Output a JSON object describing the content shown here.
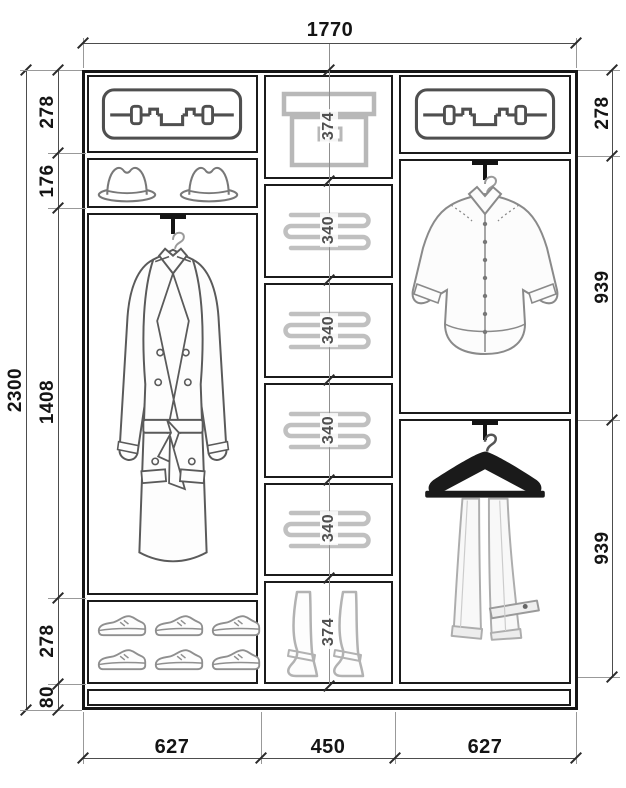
{
  "diagram": {
    "type": "wardrobe-interior-elevation",
    "units": "mm",
    "overall": {
      "width": "1770",
      "height": "2300"
    },
    "left_segments": [
      "278",
      "176",
      "1408",
      "278",
      "80"
    ],
    "middle_segments": [
      "374",
      "340",
      "340",
      "340",
      "340",
      "374"
    ],
    "right_segments": [
      "278",
      "939",
      "939"
    ],
    "bottom_widths": [
      "627",
      "450",
      "627"
    ],
    "icons": [
      {
        "name": "suitcase-icon",
        "location": "left-top-shelf"
      },
      {
        "name": "hat-icon",
        "location": "left-hat-shelf"
      },
      {
        "name": "coat-icon",
        "location": "left-hanging-section"
      },
      {
        "name": "shoes-icon",
        "location": "left-shoe-shelf"
      },
      {
        "name": "storage-box-icon",
        "location": "middle-top-shelf"
      },
      {
        "name": "folded-clothes-icon",
        "location": "middle-shelves"
      },
      {
        "name": "boots-icon",
        "location": "middle-bottom-shelf"
      },
      {
        "name": "suitcase-icon",
        "location": "right-top-shelf"
      },
      {
        "name": "shirt-icon",
        "location": "right-upper-hanging"
      },
      {
        "name": "trousers-icon",
        "location": "right-lower-hanging"
      }
    ],
    "colors": {
      "line": "#1b1b1b",
      "dimension": "#4d4d4d",
      "icon_gray": "#bcbcbc",
      "sketch_gray": "#707070",
      "hanger_black": "#161616",
      "background": "#ffffff"
    }
  }
}
